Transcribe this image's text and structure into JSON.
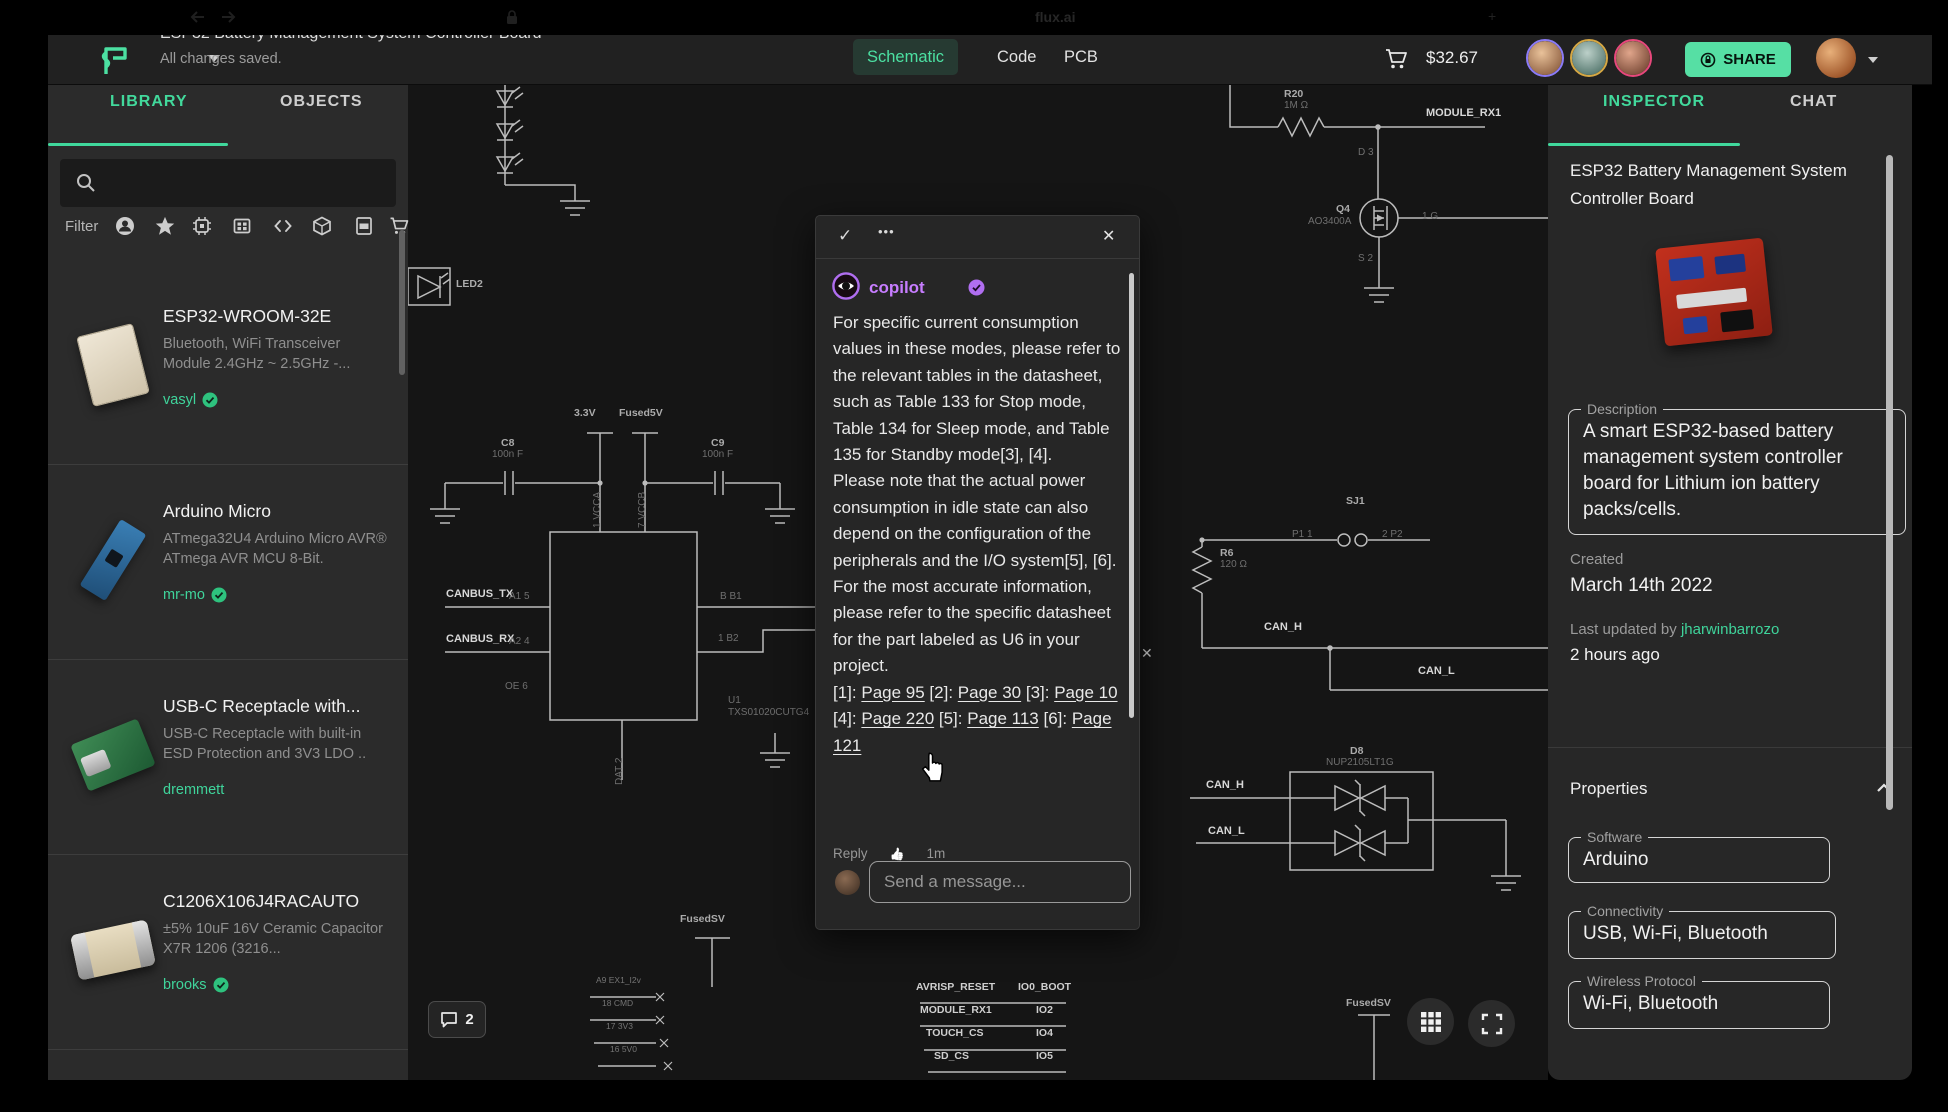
{
  "browser": {
    "tab_title": "flux.ai"
  },
  "top_bar": {
    "title": "ESP32 Battery Management System Controller Board",
    "autosave": "All changes saved.",
    "tabs": [
      {
        "label": "Schematic",
        "active": true
      },
      {
        "label": "Code",
        "active": false
      },
      {
        "label": "PCB",
        "active": false
      }
    ],
    "cart_total": "$32.67",
    "share_label": "SHARE",
    "accent": "#56dfa4",
    "collaborator_ring_colors": [
      "#8b7bf7",
      "#d6a844",
      "#e8487c"
    ]
  },
  "library": {
    "tabs": [
      {
        "label": "LIBRARY",
        "active": true
      },
      {
        "label": "OBJECTS",
        "active": false
      }
    ],
    "filter_label": "Filter",
    "filter_icons": [
      "user",
      "star",
      "chip",
      "module",
      "code",
      "package",
      "pdf",
      "cart"
    ],
    "items": [
      {
        "name": "ESP32-WROOM-32E",
        "desc": "Bluetooth, WiFi Transceiver Module 2.4GHz ~ 2.5GHz -...",
        "author": "vasyl",
        "verified": true,
        "thumb": "esp32"
      },
      {
        "name": "Arduino Micro",
        "desc": "ATmega32U4 Arduino Micro AVR® ATmega AVR MCU 8-Bit.",
        "author": "mr-mo",
        "verified": true,
        "thumb": "arduino"
      },
      {
        "name": "USB-C Receptacle with...",
        "desc": "USB-C Receptacle with built-in ESD Protection and 3V3 LDO ..",
        "author": "dremmett",
        "verified": false,
        "thumb": "usbc"
      },
      {
        "name": "C1206X106J4RACAUTO",
        "desc": "±5% 10uF 16V Ceramic Capacitor X7R 1206 (3216...",
        "author": "brooks",
        "verified": true,
        "thumb": "cap"
      }
    ]
  },
  "canvas": {
    "comment_count": "2",
    "close_x": "✕",
    "labels": [
      {
        "t": "3.3V",
        "x": 166,
        "y": 322,
        "c": "ref"
      },
      {
        "t": "Fused5V",
        "x": 211,
        "y": 322,
        "c": "ref"
      },
      {
        "t": "C8",
        "x": 93,
        "y": 352,
        "c": "ref"
      },
      {
        "t": "100n F",
        "x": 84,
        "y": 364,
        "c": "pin"
      },
      {
        "t": "C9",
        "x": 303,
        "y": 352,
        "c": "ref"
      },
      {
        "t": "100n F",
        "x": 294,
        "y": 364,
        "c": "pin"
      },
      {
        "t": "1 VCCA",
        "x": 184,
        "y": 443,
        "c": "vert"
      },
      {
        "t": "7 VCCB",
        "x": 229,
        "y": 443,
        "c": "vert"
      },
      {
        "t": "CANBUS_TX",
        "x": 38,
        "y": 503,
        "c": "net"
      },
      {
        "t": "A1 5",
        "x": 101,
        "y": 506,
        "c": "pin"
      },
      {
        "t": "CANBUS_RX",
        "x": 38,
        "y": 548,
        "c": "net"
      },
      {
        "t": "A2 4",
        "x": 101,
        "y": 551,
        "c": "pin"
      },
      {
        "t": "OE 6",
        "x": 97,
        "y": 596,
        "c": "pin"
      },
      {
        "t": "B B1",
        "x": 312,
        "y": 506,
        "c": "pin"
      },
      {
        "t": "1 B2",
        "x": 310,
        "y": 548,
        "c": "pin"
      },
      {
        "t": "U1",
        "x": 320,
        "y": 610,
        "c": "pin"
      },
      {
        "t": "TXS01020CUTG4",
        "x": 320,
        "y": 622,
        "c": "pin"
      },
      {
        "t": "DAT 2",
        "x": 206,
        "y": 700,
        "c": "vert"
      },
      {
        "t": "LED2",
        "x": 48,
        "y": 193,
        "c": "ref"
      },
      {
        "t": "R20",
        "x": 876,
        "y": 3,
        "c": "ref"
      },
      {
        "t": "1M Ω",
        "x": 876,
        "y": 15,
        "c": "pin"
      },
      {
        "t": "MODULE_RX1",
        "x": 1018,
        "y": 22,
        "c": "net"
      },
      {
        "t": "D 3",
        "x": 950,
        "y": 62,
        "c": "pin"
      },
      {
        "t": "Q4",
        "x": 928,
        "y": 118,
        "c": "ref"
      },
      {
        "t": "AO3400A",
        "x": 900,
        "y": 131,
        "c": "pin"
      },
      {
        "t": "1 G",
        "x": 1014,
        "y": 126,
        "c": "pin"
      },
      {
        "t": "S 2",
        "x": 950,
        "y": 168,
        "c": "pin"
      },
      {
        "t": "SJ1",
        "x": 938,
        "y": 410,
        "c": "ref"
      },
      {
        "t": "P1 1",
        "x": 884,
        "y": 444,
        "c": "pin"
      },
      {
        "t": "2 P2",
        "x": 974,
        "y": 444,
        "c": "pin"
      },
      {
        "t": "R6",
        "x": 812,
        "y": 462,
        "c": "ref"
      },
      {
        "t": "120 Ω",
        "x": 812,
        "y": 474,
        "c": "pin"
      },
      {
        "t": "CAN_H",
        "x": 856,
        "y": 536,
        "c": "net"
      },
      {
        "t": "CAN_L",
        "x": 1010,
        "y": 580,
        "c": "net"
      },
      {
        "t": "D8",
        "x": 942,
        "y": 660,
        "c": "ref"
      },
      {
        "t": "NUP2105LT1G",
        "x": 918,
        "y": 672,
        "c": "pin"
      },
      {
        "t": "CAN_H",
        "x": 798,
        "y": 694,
        "c": "net"
      },
      {
        "t": "CAN_L",
        "x": 800,
        "y": 740,
        "c": "net"
      },
      {
        "t": "FusedSV",
        "x": 272,
        "y": 828,
        "c": "ref"
      },
      {
        "t": "FusedSV",
        "x": 938,
        "y": 912,
        "c": "ref"
      },
      {
        "t": "AVRISP_RESET",
        "x": 508,
        "y": 896,
        "c": "netsm"
      },
      {
        "t": "IO0_BOOT",
        "x": 610,
        "y": 896,
        "c": "netsm"
      },
      {
        "t": "MODULE_RX1",
        "x": 512,
        "y": 919,
        "c": "netsm"
      },
      {
        "t": "IO2",
        "x": 628,
        "y": 919,
        "c": "netsm"
      },
      {
        "t": "TOUCH_CS",
        "x": 518,
        "y": 942,
        "c": "netsm"
      },
      {
        "t": "IO4",
        "x": 628,
        "y": 942,
        "c": "netsm"
      },
      {
        "t": "SD_CS",
        "x": 526,
        "y": 965,
        "c": "netsm"
      },
      {
        "t": "IO5",
        "x": 628,
        "y": 965,
        "c": "netsm"
      },
      {
        "t": "A9 EX1_I2v",
        "x": 188,
        "y": 890,
        "c": "tiny"
      },
      {
        "t": "18 CMD",
        "x": 194,
        "y": 913,
        "c": "tiny"
      },
      {
        "t": "17 3V3",
        "x": 198,
        "y": 936,
        "c": "tiny"
      },
      {
        "t": "16 5V0",
        "x": 202,
        "y": 959,
        "c": "tiny"
      }
    ]
  },
  "popup": {
    "author": "copilot",
    "header": {
      "check": "✓",
      "dots": "•••",
      "close": "✕"
    },
    "paragraphs": [
      "For specific current consumption values in these modes, please refer to the relevant tables in the datasheet, such as Table 133 for Stop mode, Table 134 for Sleep mode, and Table 135 for Standby mode[3], [4].",
      "Please note that the actual power consumption in idle state can also depend on the configuration of the peripherals and the I/O system[5], [6].",
      "For the most accurate information, please refer to the specific datasheet for the part labeled as U6 in your project."
    ],
    "citations": [
      {
        "pre": "[1]: ",
        "link": "Page 95"
      },
      {
        "pre": " [2]: ",
        "link": "Page 30"
      },
      {
        "pre": " [3]: ",
        "link": "Page 10"
      },
      {
        "pre": " [4]: ",
        "link": "Page 220"
      },
      {
        "pre": " [5]: ",
        "link": "Page 113"
      },
      {
        "pre": " [6]: ",
        "link": "Page 121"
      }
    ],
    "reply_label": "Reply",
    "like_icon": "👍",
    "time": "1m",
    "input_placeholder": "Send a message..."
  },
  "inspector": {
    "tabs": [
      {
        "label": "INSPECTOR",
        "active": true
      },
      {
        "label": "CHAT",
        "active": false
      }
    ],
    "title": "ESP32 Battery Management System Controller Board",
    "description_label": "Description",
    "description": "A smart ESP32-based battery management system controller board for Lithium ion battery packs/cells.",
    "created_label": "Created",
    "created": "March 14th 2022",
    "updated_label": "Last updated by",
    "updated_by": "jharwinbarrozo",
    "updated_time": "2 hours ago",
    "properties_label": "Properties",
    "properties": [
      {
        "label": "Software",
        "value": "Arduino"
      },
      {
        "label": "Connectivity",
        "value": "USB, Wi-Fi, Bluetooth"
      },
      {
        "label": "Wireless Protocol",
        "value": "Wi-Fi, Bluetooth"
      }
    ]
  }
}
